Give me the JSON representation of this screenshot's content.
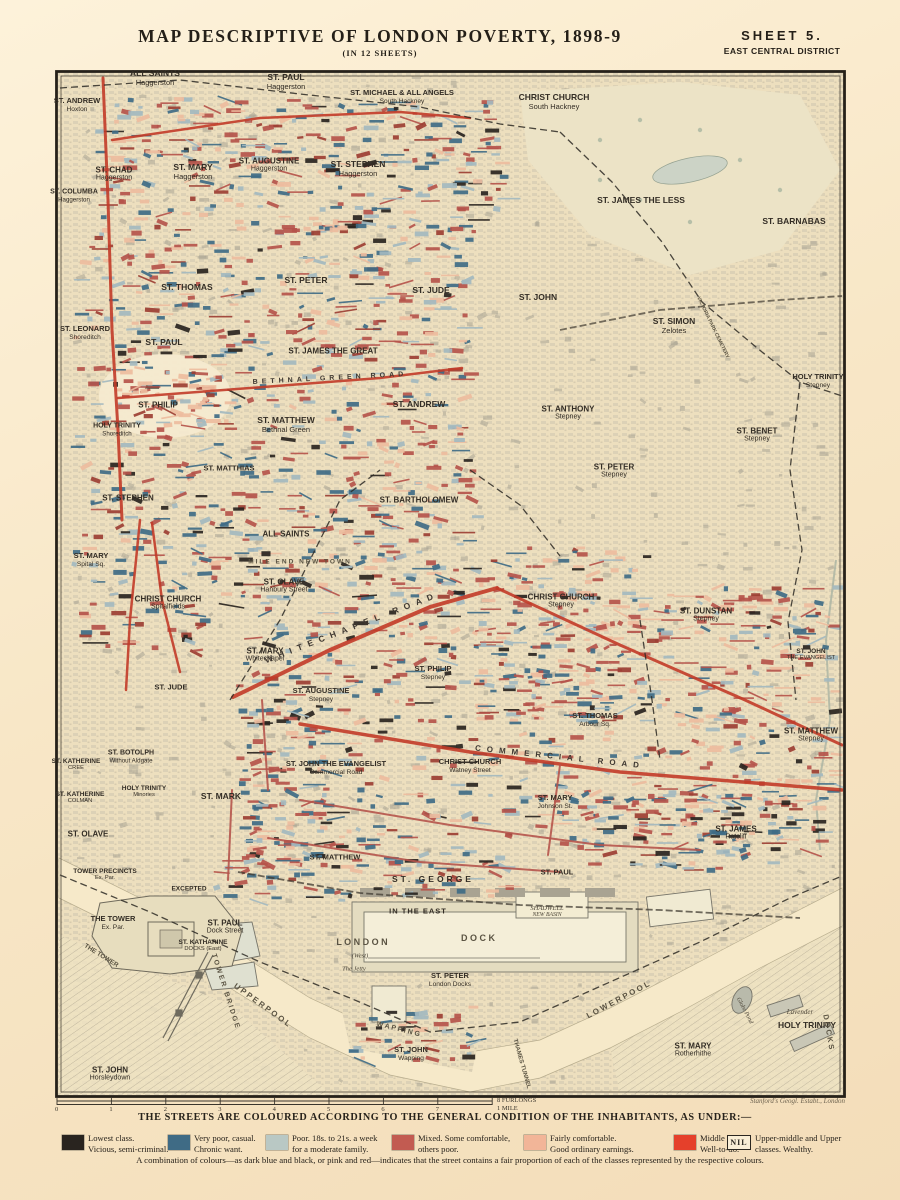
{
  "header": {
    "title": "MAP  DESCRIPTIVE  OF  LONDON  POVERTY,  1898-9",
    "subtitle": "(IN 12 SHEETS)",
    "sheet": "SHEET  5.",
    "district": "EAST CENTRAL DISTRICT"
  },
  "imprint": "Stanford's Geogl. Estabt., London",
  "scale": {
    "ticks": [
      "0",
      "1",
      "2",
      "3",
      "4",
      "5",
      "6",
      "7"
    ],
    "end_label": "8 FURLONGS",
    "mile_label": "1 MILE"
  },
  "colors": {
    "lowest_black": "#29241f",
    "very_poor_blue": "#3f6b85",
    "poor_lightblue": "#a3b8bf",
    "mixed_red": "#b5544b",
    "fairly_pink": "#edbc9e",
    "middle_red": "#e5402b",
    "dark_red_road": "#c23b28",
    "paper": "#f1e1c0"
  },
  "legend": {
    "heading": "THE  STREETS  ARE  COLOURED  ACCORDING  TO  THE  GENERAL  CONDITION  OF  THE  INHABITANTS,  AS  UNDER:—",
    "nil_label": "NIL",
    "entries": [
      {
        "color": "#29241f",
        "line1": "Lowest class.",
        "line2": "Vicious, semi-criminal."
      },
      {
        "color": "#3f6b85",
        "line1": "Very poor, casual.",
        "line2": "Chronic want."
      },
      {
        "color": "#b9c8c4",
        "line1": "Poor.  18s. to 21s. a week",
        "line2": "for a moderate family."
      },
      {
        "color": "#c25b51",
        "line1": "Mixed.  Some comfortable,",
        "line2": "others poor."
      },
      {
        "color": "#f2b598",
        "line1": "Fairly comfortable.",
        "line2": "Good ordinary earnings."
      },
      {
        "color": "#e5402b",
        "line1": "Middle class.",
        "line2": "Well-to-do."
      },
      {
        "color": "NIL",
        "line1": "Upper-middle and Upper",
        "line2": "classes.  Wealthy."
      }
    ],
    "footnote": "A combination of colours—as dark blue and black, or pink and red—indicates that the street contains a fair proportion of each of the classes represented by the respective colours."
  },
  "map": {
    "labels": [
      {
        "t": "ALL SAINTS",
        "s": "Haggerston",
        "x": 155,
        "y": 78,
        "fs": 8.5
      },
      {
        "t": "ST. PAUL",
        "s": "Haggerston",
        "x": 286,
        "y": 82,
        "fs": 8.5
      },
      {
        "t": "ST. MICHAEL & ALL ANGELS",
        "s": "South Hackney",
        "x": 402,
        "y": 97,
        "fs": 7.5
      },
      {
        "t": "CHRIST CHURCH",
        "s": "South Hackney",
        "x": 554,
        "y": 102,
        "fs": 8.5
      },
      {
        "t": "ST. ANDREW",
        "s": "Hoxton",
        "x": 77,
        "y": 105,
        "fs": 7.5
      },
      {
        "t": "ST. CHAD",
        "s": "Haggerston",
        "x": 114,
        "y": 174,
        "fs": 8
      },
      {
        "t": "ST. MARY",
        "s": "Haggerston",
        "x": 193,
        "y": 172,
        "fs": 8.5
      },
      {
        "t": "ST. AUGUSTINE",
        "s": "Haggerston",
        "x": 269,
        "y": 165,
        "fs": 8
      },
      {
        "t": "ST. STEPHEN",
        "s": "Haggerston",
        "x": 358,
        "y": 169,
        "fs": 8.5
      },
      {
        "t": "ST. COLUMBA",
        "s": "Haggerston",
        "x": 74,
        "y": 196,
        "fs": 7
      },
      {
        "t": "ST. JAMES THE LESS",
        "x": 641,
        "y": 201,
        "fs": 8.5
      },
      {
        "t": "ST. BARNABAS",
        "x": 794,
        "y": 222,
        "fs": 8.5
      },
      {
        "t": "ST. THOMAS",
        "x": 187,
        "y": 288,
        "fs": 8.5
      },
      {
        "t": "ST. PETER",
        "x": 306,
        "y": 281,
        "fs": 8.5
      },
      {
        "t": "ST. JUDE",
        "x": 431,
        "y": 291,
        "fs": 8.5
      },
      {
        "t": "ST. JOHN",
        "x": 538,
        "y": 298,
        "fs": 8.5
      },
      {
        "t": "ST. LEONARD",
        "s": "Shoreditch",
        "x": 85,
        "y": 333,
        "fs": 7.5
      },
      {
        "t": "ST. PAUL",
        "x": 164,
        "y": 343,
        "fs": 8.5
      },
      {
        "t": "ST. JAMES THE GREAT",
        "x": 333,
        "y": 351,
        "fs": 8
      },
      {
        "t": "ST. SIMON",
        "s": "Zelotes",
        "x": 674,
        "y": 326,
        "fs": 8.5
      },
      {
        "t": "ST. PHILIP",
        "x": 158,
        "y": 405,
        "fs": 8
      },
      {
        "t": "ST. ANDREW",
        "x": 419,
        "y": 405,
        "fs": 8.5
      },
      {
        "t": "ST. MATTHEW",
        "s": "Bethnal Green",
        "x": 286,
        "y": 425,
        "fs": 8.5
      },
      {
        "t": "HOLY TRINITY",
        "s": "Shoreditch",
        "x": 117,
        "y": 430,
        "fs": 7
      },
      {
        "t": "HOLY TRINITY",
        "s": "Stepney",
        "x": 818,
        "y": 381,
        "fs": 7.5
      },
      {
        "t": "ST. ANTHONY",
        "s": "Stepney",
        "x": 568,
        "y": 413,
        "fs": 8
      },
      {
        "t": "ST. BENET",
        "s": "Stepney",
        "x": 757,
        "y": 435,
        "fs": 8
      },
      {
        "t": "ST. PETER",
        "s": "Stepney",
        "x": 614,
        "y": 471,
        "fs": 8
      },
      {
        "t": "ST. MATTHIAS",
        "x": 229,
        "y": 469,
        "fs": 7.5
      },
      {
        "t": "ST. STEPHEN",
        "x": 128,
        "y": 498,
        "fs": 8
      },
      {
        "t": "ST. BARTHOLOMEW",
        "x": 419,
        "y": 500,
        "fs": 8
      },
      {
        "t": "ALL SAINTS",
        "x": 286,
        "y": 534,
        "fs": 8
      },
      {
        "t": "ST. MARY",
        "s": "Spital Sq.",
        "x": 91,
        "y": 560,
        "fs": 7.5
      },
      {
        "t": "ST. OLAVE",
        "s": "Hanbury Street",
        "x": 284,
        "y": 586,
        "fs": 8
      },
      {
        "t": "CHRIST CHURCH",
        "s": "Spitalfields",
        "x": 168,
        "y": 603,
        "fs": 8
      },
      {
        "t": "CHRIST CHURCH",
        "s": "Stepney",
        "x": 561,
        "y": 601,
        "fs": 8
      },
      {
        "t": "ST. DUNSTAN",
        "s": "Stepney",
        "x": 706,
        "y": 615,
        "fs": 8
      },
      {
        "t": "ST. JOHN",
        "s": "THE EVANGELIST",
        "x": 811,
        "y": 655,
        "fs": 6.5
      },
      {
        "t": "ST. MARY",
        "s": "Whitechapel",
        "x": 265,
        "y": 655,
        "fs": 8
      },
      {
        "t": "ST. JUDE",
        "x": 171,
        "y": 688,
        "fs": 7.5
      },
      {
        "t": "ST. PHILIP",
        "s": "Stepney",
        "x": 433,
        "y": 673,
        "fs": 7.5
      },
      {
        "t": "ST. AUGUSTINE",
        "s": "Stepney",
        "x": 321,
        "y": 695,
        "fs": 7.5
      },
      {
        "t": "ST. THOMAS",
        "s": "Arbour Sq.",
        "x": 595,
        "y": 720,
        "fs": 7.5
      },
      {
        "t": "ST. MATTHEW",
        "s": "Stepney",
        "x": 811,
        "y": 735,
        "fs": 8
      },
      {
        "t": "ST. BOTOLPH",
        "s": "Without Aldgate",
        "x": 131,
        "y": 757,
        "fs": 7
      },
      {
        "t": "ST. KATHERINE",
        "s": "CREE",
        "x": 76,
        "y": 765,
        "fs": 6.5
      },
      {
        "t": "ST. JOHN THE EVANGELIST",
        "s": "Commercial Road",
        "x": 336,
        "y": 768,
        "fs": 7.5
      },
      {
        "t": "CHRIST CHURCH",
        "s": "Watney Street",
        "x": 470,
        "y": 766,
        "fs": 7.5
      },
      {
        "t": "HOLY TRINITY",
        "s": "Minories",
        "x": 144,
        "y": 792,
        "fs": 6.5
      },
      {
        "t": "ST. KATHERINE",
        "s": "COLMAN",
        "x": 80,
        "y": 798,
        "fs": 6.5
      },
      {
        "t": "ST. MARK",
        "x": 221,
        "y": 797,
        "fs": 8.5
      },
      {
        "t": "ST. MARY",
        "s": "Johnson St.",
        "x": 555,
        "y": 802,
        "fs": 7.5
      },
      {
        "t": "ST. OLAVE",
        "x": 88,
        "y": 834,
        "fs": 8
      },
      {
        "t": "ST. JAMES",
        "s": "Ratcliff",
        "x": 736,
        "y": 833,
        "fs": 8
      },
      {
        "t": "TOWER PRECINCTS",
        "s": "Ex. Par.",
        "x": 105,
        "y": 875,
        "fs": 6.5
      },
      {
        "t": "ST. MATTHEW",
        "x": 335,
        "y": 858,
        "fs": 7.5
      },
      {
        "t": "ST. GEORGE",
        "x": 433,
        "y": 880,
        "fs": 8.5,
        "ls": 3
      },
      {
        "t": "EXCEPTED",
        "x": 189,
        "y": 889,
        "fs": 6.5
      },
      {
        "t": "ST. PAUL",
        "x": 557,
        "y": 873,
        "fs": 7.5
      },
      {
        "t": "IN THE EAST",
        "x": 418,
        "y": 912,
        "fs": 7.5,
        "ls": 1
      },
      {
        "t": "THE TOWER",
        "s": "Ex. Par.",
        "x": 113,
        "y": 923,
        "fs": 7.5
      },
      {
        "t": "ST. PAUL",
        "s": "Dock Street",
        "x": 225,
        "y": 927,
        "fs": 8
      },
      {
        "t": "SHADWELL",
        "s": "NEW BASIN",
        "x": 547,
        "y": 912,
        "fs": 6.5,
        "cls": "it"
      },
      {
        "t": "ST. KATHARINE",
        "s": "DOCKS (East)",
        "x": 203,
        "y": 946,
        "fs": 6.5
      },
      {
        "t": "L O N D O N",
        "x": 362,
        "y": 942,
        "fs": 9,
        "cls": "wt"
      },
      {
        "t": "D O C K",
        "x": 478,
        "y": 938,
        "fs": 9,
        "cls": "wt"
      },
      {
        "t": "(West)",
        "x": 360,
        "y": 956,
        "fs": 6.5,
        "cls": "it"
      },
      {
        "t": "The Jetty",
        "x": 354,
        "y": 969,
        "fs": 6.5,
        "cls": "it"
      },
      {
        "t": "ST. PETER",
        "s": "London Docks",
        "x": 450,
        "y": 980,
        "fs": 7.5
      },
      {
        "t": "ST. JOHN",
        "s": "Wapping",
        "x": 411,
        "y": 1054,
        "fs": 7.5
      },
      {
        "t": "ST. JOHN",
        "s": "Horsleydown",
        "x": 110,
        "y": 1074,
        "fs": 8
      },
      {
        "t": "ST. MARY",
        "s": "Rotherhithe",
        "x": 693,
        "y": 1050,
        "fs": 8
      },
      {
        "t": "HOLY TRINITY",
        "x": 807,
        "y": 1026,
        "fs": 8.5
      },
      {
        "t": "Lavender",
        "x": 800,
        "y": 1012,
        "fs": 7,
        "cls": "it"
      },
      {
        "t": "Globe Pond",
        "x": 744,
        "y": 1011,
        "fs": 6,
        "cls": "it",
        "rot": 62
      },
      {
        "t": "D O C K S",
        "x": 828,
        "y": 1032,
        "fs": 7.5,
        "rot": 80,
        "cls": "wt"
      },
      {
        "t": "THE TOWER",
        "x": 101,
        "y": 956,
        "fs": 6.5,
        "rot": 32,
        "cls": "wt"
      },
      {
        "t": "TOWER BRIDGE",
        "x": 225,
        "y": 992,
        "fs": 7,
        "rot": 72,
        "cls": "wt",
        "ls": 2
      },
      {
        "t": "U P P E R   P O O L",
        "x": 262,
        "y": 1005,
        "fs": 8,
        "rot": 36,
        "cls": "wt"
      },
      {
        "t": "L O W E R   P O O L",
        "x": 618,
        "y": 1000,
        "fs": 8,
        "rot": -28,
        "cls": "wt"
      },
      {
        "t": "THAMES TUNNEL",
        "x": 521,
        "y": 1064,
        "fs": 6,
        "rot": 74,
        "cls": "wt"
      },
      {
        "t": "W A P P I N G",
        "x": 398,
        "y": 1030,
        "fs": 7,
        "rot": 14,
        "cls": "wt"
      },
      {
        "t": "WHITECHAPEL ROAD",
        "x": 352,
        "y": 628,
        "fs": 8.5,
        "rot": -21,
        "ls": 6,
        "cls": "rd"
      },
      {
        "t": "COMMERCIAL ROAD",
        "x": 560,
        "y": 757,
        "fs": 8,
        "rot": 6,
        "ls": 6,
        "cls": "rd"
      },
      {
        "t": "BETHNAL GREEN ROAD",
        "x": 330,
        "y": 379,
        "fs": 7,
        "rot": -3,
        "ls": 4,
        "cls": "rd"
      },
      {
        "t": "MILE END NEW TOWN",
        "x": 300,
        "y": 562,
        "fs": 6.5,
        "ls": 2,
        "cls": "wt"
      },
      {
        "t": "VICTORIA PARK CEMETERY",
        "x": 712,
        "y": 328,
        "fs": 5,
        "rot": 64,
        "cls": "wt"
      }
    ]
  }
}
